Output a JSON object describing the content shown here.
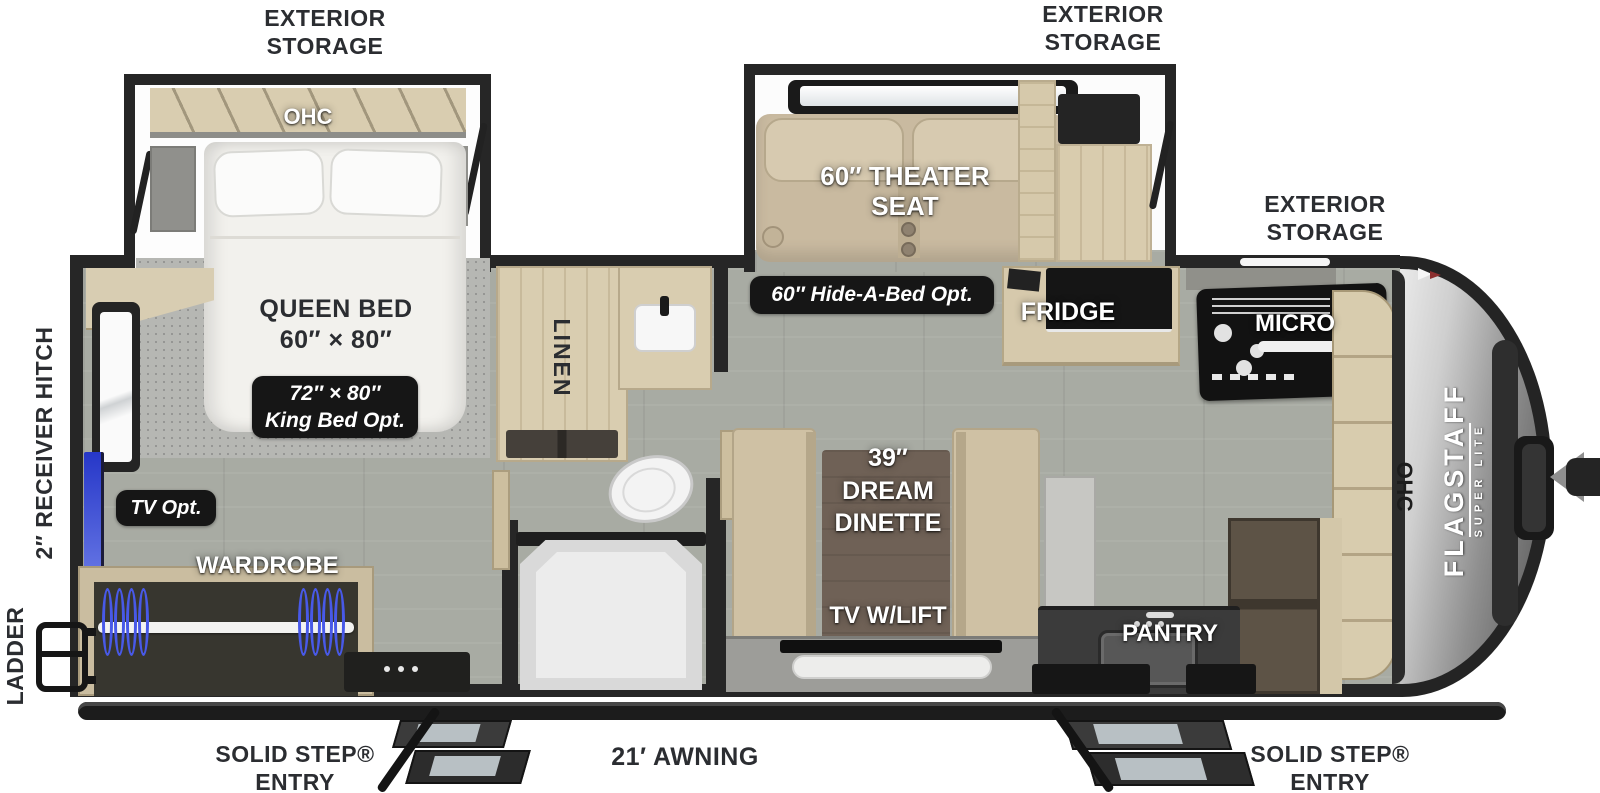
{
  "title": "Flagstaff Super Lite travel trailer floorplan",
  "colors": {
    "floor": "#a8aba3",
    "wall": "#262626",
    "cabinet": "#d9cdb0",
    "badge_bg": "#161616",
    "label_dark": "#2b2d31",
    "hanger_blue": "#4859e8",
    "tv_blue": "#3345d8",
    "front_cap_silver": "#c2c2c2"
  },
  "exterior": {
    "storage_rear": "EXTERIOR\nSTORAGE",
    "storage_mid": "EXTERIOR\nSTORAGE",
    "storage_front": "EXTERIOR\nSTORAGE",
    "receiver_hitch": "2″ RECEIVER HITCH",
    "ladder": "LADDER",
    "entry_rear": "SOLID STEP®\nENTRY",
    "awning": "21′ AWNING",
    "entry_front": "SOLID STEP®\nENTRY"
  },
  "bedroom": {
    "ohc": "OHC",
    "bed": "QUEEN BED\n60″ × 80″",
    "king_opt": "72″ × 80″\nKing Bed Opt.",
    "tv_opt": "TV Opt.",
    "wardrobe": "WARDROBE"
  },
  "bathroom": {
    "linen": "LINEN"
  },
  "living": {
    "theater_seat": "60″ THEATER\nSEAT",
    "hide_a_bed_opt": "60″ Hide-A-Bed Opt.",
    "dinette": "39″\nDREAM\nDINETTE",
    "tv_lift": "TV W/LIFT"
  },
  "kitchen": {
    "fridge": "FRIDGE",
    "micro": "MICRO",
    "pantry": "PANTRY",
    "ohc": "OHC"
  },
  "brand": {
    "name": "FLAGSTAFF",
    "model": "SUPER LITE"
  }
}
